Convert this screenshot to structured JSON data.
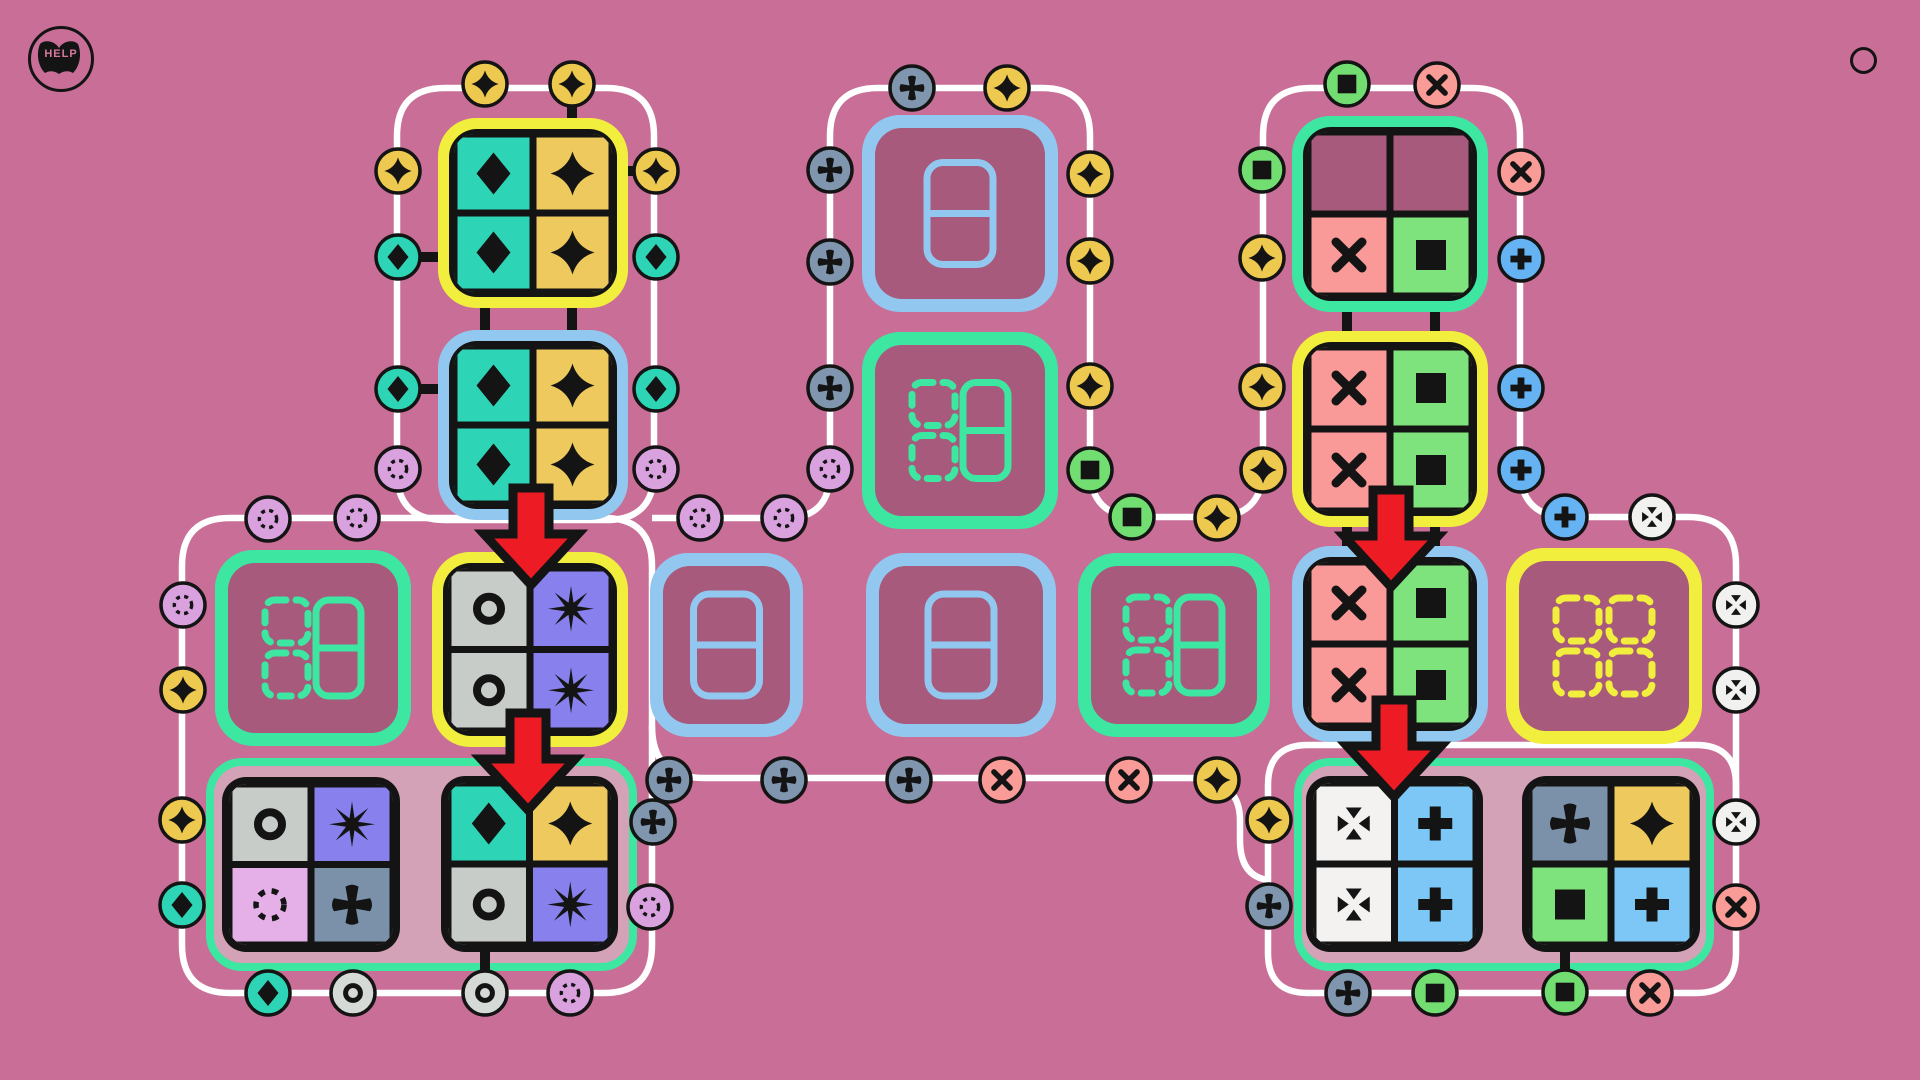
{
  "help": {
    "label": "HELP"
  },
  "palette": {
    "bg": "#c86e97",
    "ink": "#141414",
    "path_white": "#ffffff",
    "tile_empty": "#a75a7c",
    "container": "#d4a2b6",
    "border_yellow": "#f1ee3d",
    "border_blue": "#92c8f0",
    "border_green": "#3de6a1",
    "cell_teal": "#2ed4b6",
    "cell_gold": "#edc95e",
    "cell_gray": "#c8ccc9",
    "cell_purple": "#8880ec",
    "cell_lavender": "#e5afe8",
    "cell_bluegray": "#7b90a9",
    "cell_pink": "#f99a98",
    "cell_green": "#7fe37d",
    "cell_white": "#f3f2f0",
    "cell_lightblue": "#7cc7f6",
    "cell_empty": "#a75a7c",
    "badge_gold": "#eec94f",
    "badge_teal": "#2ed4b6",
    "badge_lavender": "#d9a2df",
    "badge_bluegray": "#8095ae",
    "badge_pink": "#f99b97",
    "badge_green": "#72dd71",
    "badge_blue": "#66b3f3",
    "badge_white": "#f1f1ef",
    "badge_gray": "#d6dad7",
    "arrow_red": "#ed1c24"
  },
  "board": {
    "width": 1920,
    "height": 1080,
    "track_paths": [
      "M445,88 H606 Q654,88 654,136 V472 Q654,520 606,520 H445 Q397,520 397,472 V136 Q397,88 445,88 Z",
      "M230,518 H604 Q652,518 652,566 V945 Q652,993 604,993 H230 Q182,993 182,945 V566 Q182,518 230,518 Z",
      "M652,518 H786 Q830,518 830,472 V136 Q830,88 878,88 H1042 Q1090,88 1090,136 V468 Q1090,517 1138,517 H1214 Q1263,517 1263,468 V136 Q1263,88 1311,88 H1472 Q1520,88 1520,136 V468 Q1520,517 1568,517 H1688 Q1736,517 1736,565 V810",
      "M652,726 Q652,778 704,778 H1188 Q1240,778 1240,820 V840 Q1240,876 1268,880",
      "M1308,745 H1696 Q1736,745 1736,785 V953 Q1736,993 1696,993 H1308 Q1268,993 1268,953 V785 Q1268,745 1308,745 Z"
    ],
    "containers": [
      {
        "x": 210,
        "y": 762,
        "w": 423,
        "h": 205
      },
      {
        "x": 1298,
        "y": 762,
        "w": 412,
        "h": 205
      }
    ],
    "connectors": [
      [
        572,
        84,
        572,
        124
      ],
      [
        628,
        171,
        657,
        171
      ],
      [
        398,
        257,
        444,
        257
      ],
      [
        398,
        389,
        444,
        389
      ],
      [
        485,
        300,
        485,
        338
      ],
      [
        572,
        300,
        572,
        338
      ],
      [
        1347,
        304,
        1347,
        339
      ],
      [
        1435,
        304,
        1435,
        339
      ],
      [
        1347,
        519,
        1347,
        554
      ],
      [
        1435,
        519,
        1435,
        554
      ],
      [
        485,
        944,
        485,
        975
      ],
      [
        1565,
        944,
        1565,
        975
      ]
    ],
    "tiles": [
      {
        "id": "A1",
        "x": 438,
        "y": 118,
        "w": 190,
        "h": 190,
        "border": "yellow",
        "cells": [
          "teal:diamond",
          "gold:star4",
          "teal:diamond",
          "gold:star4"
        ]
      },
      {
        "id": "A2",
        "x": 438,
        "y": 330,
        "w": 190,
        "h": 190,
        "border": "blue",
        "cells": [
          "teal:diamond",
          "gold:star4",
          "teal:diamond",
          "gold:star4"
        ]
      },
      {
        "id": "E1",
        "x": 215,
        "y": 550,
        "w": 196,
        "h": 196,
        "border": "green",
        "empty": "quad-green"
      },
      {
        "id": "B1",
        "x": 432,
        "y": 552,
        "w": 196,
        "h": 195,
        "border": "yellow",
        "cells": [
          "gray:ring",
          "purple:burst",
          "gray:ring",
          "purple:burst"
        ]
      },
      {
        "id": "M1",
        "x": 862,
        "y": 115,
        "w": 196,
        "h": 197,
        "border": "blue",
        "empty": "domino-blue"
      },
      {
        "id": "M2",
        "x": 862,
        "y": 332,
        "w": 196,
        "h": 197,
        "border": "green",
        "empty": "quad-green"
      },
      {
        "id": "T1",
        "x": 650,
        "y": 553,
        "w": 153,
        "h": 184,
        "border": "blue",
        "empty": "domino-blue"
      },
      {
        "id": "T2",
        "x": 866,
        "y": 553,
        "w": 190,
        "h": 184,
        "border": "blue",
        "empty": "domino-blue"
      },
      {
        "id": "T3",
        "x": 1078,
        "y": 553,
        "w": 192,
        "h": 184,
        "border": "green",
        "empty": "quad-green"
      },
      {
        "id": "R1",
        "x": 1292,
        "y": 116,
        "w": 196,
        "h": 196,
        "border": "green",
        "cells": [
          "empty:none",
          "empty:none",
          "pink:x",
          "green:square"
        ]
      },
      {
        "id": "R2",
        "x": 1292,
        "y": 331,
        "w": 196,
        "h": 196,
        "border": "yellow",
        "cells": [
          "pink:x",
          "green:square",
          "pink:x",
          "green:square"
        ]
      },
      {
        "id": "R3",
        "x": 1292,
        "y": 546,
        "w": 196,
        "h": 196,
        "border": "blue",
        "cells": [
          "pink:x",
          "green:square",
          "pink:x",
          "green:square"
        ]
      },
      {
        "id": "E2",
        "x": 1506,
        "y": 548,
        "w": 196,
        "h": 196,
        "border": "yellow",
        "empty": "quad-yellow"
      },
      {
        "id": "C1",
        "x": 222,
        "y": 777,
        "w": 178,
        "h": 175,
        "border": "none",
        "cells": [
          "gray:ring",
          "purple:burst",
          "lavender:dotring",
          "bluegray:cross"
        ]
      },
      {
        "id": "C2",
        "x": 441,
        "y": 776,
        "w": 177,
        "h": 176,
        "border": "none",
        "cells": [
          "teal:diamond",
          "gold:star4",
          "gray:ring",
          "purple:burst"
        ]
      },
      {
        "id": "D1",
        "x": 1306,
        "y": 776,
        "w": 177,
        "h": 176,
        "border": "none",
        "cells": [
          "white:converge",
          "lightblue:plus",
          "white:converge",
          "lightblue:plus"
        ]
      },
      {
        "id": "D2",
        "x": 1522,
        "y": 776,
        "w": 178,
        "h": 176,
        "border": "none",
        "cells": [
          "bluegray:cross",
          "gold:star4",
          "green:square",
          "lightblue:plus"
        ]
      }
    ],
    "arrows": [
      {
        "x": 531,
        "y": 488
      },
      {
        "x": 528,
        "y": 713
      },
      {
        "x": 1391,
        "y": 490
      },
      {
        "x": 1394,
        "y": 700
      }
    ],
    "badges": [
      [
        485,
        84,
        "gold",
        "star4"
      ],
      [
        572,
        84,
        "gold",
        "star4"
      ],
      [
        398,
        171,
        "gold",
        "star4"
      ],
      [
        656,
        171,
        "gold",
        "star4"
      ],
      [
        398,
        257,
        "teal",
        "diamond"
      ],
      [
        656,
        257,
        "teal",
        "diamond"
      ],
      [
        398,
        389,
        "teal",
        "diamond"
      ],
      [
        656,
        389,
        "teal",
        "diamond"
      ],
      [
        398,
        469,
        "lavender",
        "dotring"
      ],
      [
        656,
        469,
        "lavender",
        "dotring"
      ],
      [
        700,
        518,
        "lavender",
        "dotring"
      ],
      [
        784,
        518,
        "lavender",
        "dotring"
      ],
      [
        268,
        519,
        "lavender",
        "dotring"
      ],
      [
        357,
        518,
        "lavender",
        "dotring"
      ],
      [
        183,
        605,
        "lavender",
        "dotring"
      ],
      [
        183,
        690,
        "gold",
        "star4"
      ],
      [
        182,
        820,
        "gold",
        "star4"
      ],
      [
        182,
        905,
        "teal",
        "diamond"
      ],
      [
        268,
        993,
        "teal",
        "diamond"
      ],
      [
        353,
        993,
        "gray",
        "ring"
      ],
      [
        485,
        993,
        "gray",
        "ring"
      ],
      [
        570,
        993,
        "lavender",
        "dotring"
      ],
      [
        653,
        822,
        "bluegray",
        "cross"
      ],
      [
        650,
        907,
        "lavender",
        "dotring"
      ],
      [
        830,
        170,
        "bluegray",
        "cross"
      ],
      [
        830,
        262,
        "bluegray",
        "cross"
      ],
      [
        830,
        388,
        "bluegray",
        "cross"
      ],
      [
        830,
        469,
        "lavender",
        "dotring"
      ],
      [
        912,
        88,
        "bluegray",
        "cross"
      ],
      [
        1007,
        88,
        "gold",
        "star4"
      ],
      [
        1090,
        174,
        "gold",
        "star4"
      ],
      [
        1090,
        261,
        "gold",
        "star4"
      ],
      [
        1090,
        386,
        "gold",
        "star4"
      ],
      [
        1090,
        470,
        "green",
        "square"
      ],
      [
        1132,
        517,
        "green",
        "square"
      ],
      [
        1217,
        518,
        "gold",
        "star4"
      ],
      [
        1263,
        470,
        "gold",
        "star4"
      ],
      [
        1262,
        170,
        "green",
        "square"
      ],
      [
        1262,
        258,
        "gold",
        "star4"
      ],
      [
        1262,
        387,
        "gold",
        "star4"
      ],
      [
        1347,
        84,
        "green",
        "square"
      ],
      [
        1437,
        85,
        "pink",
        "x"
      ],
      [
        1521,
        172,
        "pink",
        "x"
      ],
      [
        1521,
        259,
        "blue",
        "plus"
      ],
      [
        1521,
        388,
        "blue",
        "plus"
      ],
      [
        1521,
        470,
        "blue",
        "plus"
      ],
      [
        1565,
        517,
        "blue",
        "plus"
      ],
      [
        1652,
        517,
        "white",
        "converge"
      ],
      [
        1736,
        605,
        "white",
        "converge"
      ],
      [
        1736,
        690,
        "white",
        "converge"
      ],
      [
        1736,
        822,
        "white",
        "converge"
      ],
      [
        1736,
        907,
        "pink",
        "x"
      ],
      [
        1650,
        993,
        "pink",
        "x"
      ],
      [
        1565,
        992,
        "green",
        "square"
      ],
      [
        1435,
        993,
        "green",
        "square"
      ],
      [
        1348,
        993,
        "bluegray",
        "cross"
      ],
      [
        1269,
        906,
        "bluegray",
        "cross"
      ],
      [
        1269,
        820,
        "gold",
        "star4"
      ],
      [
        669,
        780,
        "bluegray",
        "cross"
      ],
      [
        784,
        780,
        "bluegray",
        "cross"
      ],
      [
        909,
        780,
        "bluegray",
        "cross"
      ],
      [
        1002,
        780,
        "pink",
        "x"
      ],
      [
        1129,
        780,
        "pink",
        "x"
      ],
      [
        1217,
        780,
        "gold",
        "star4"
      ]
    ]
  }
}
